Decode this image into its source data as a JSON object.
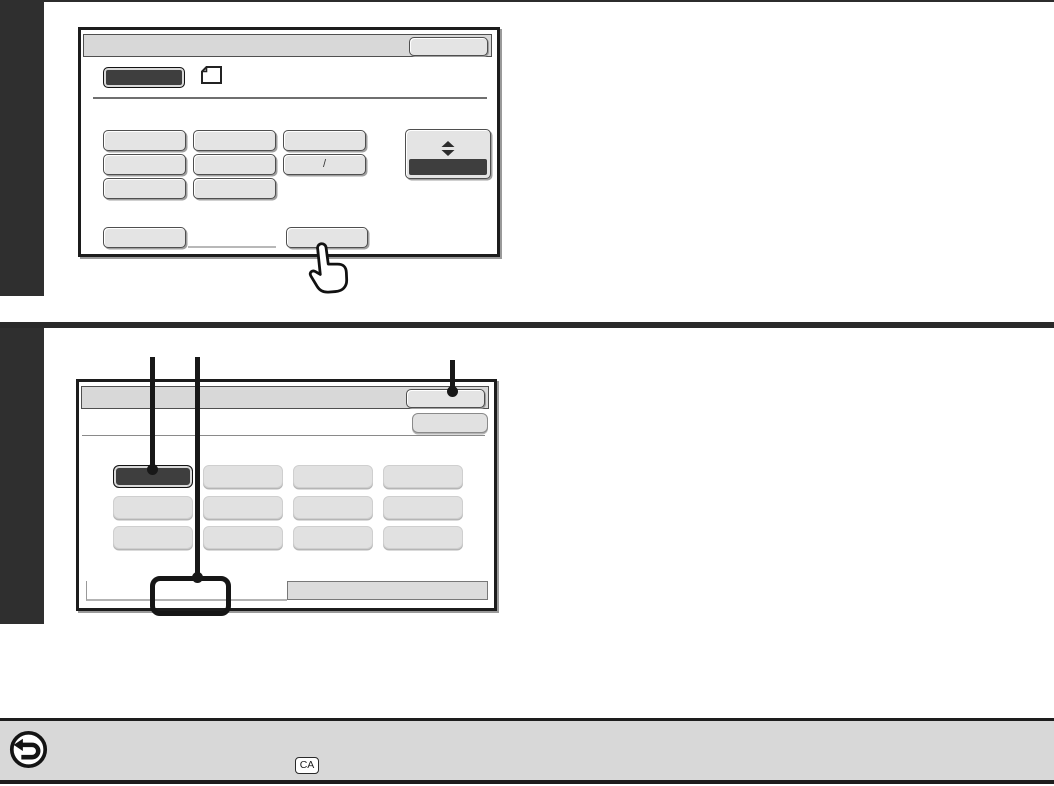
{
  "theme": {
    "sidebar_color": "#2f2f2f",
    "outline_color": "#1c1c1c",
    "titlebar_fill": "#d8d8d8",
    "button_fill": "#e4e4e4",
    "dark_button_fill": "#3e3e3e",
    "footer_fill": "#d8d8d8"
  },
  "screen1": {
    "titlebar": {
      "label": "",
      "action_button": ""
    },
    "mode_button": "",
    "original_icon": "original-document-icon",
    "buttons": {
      "r1c1": "",
      "r1c2": "",
      "r1c3": "",
      "r2c1": "",
      "r2c2": "",
      "r2c3": "/",
      "r3c1": "",
      "r3c2": ""
    },
    "scroll_button_icon": "up-down-arrows-icon",
    "bottom": {
      "left": "",
      "right": ""
    }
  },
  "screen2": {
    "titlebar": {
      "label": "",
      "action_button": ""
    },
    "header_button": "",
    "buttons": [
      "",
      "",
      "",
      "",
      "",
      "",
      "",
      "",
      "",
      "",
      "",
      ""
    ],
    "selected_index": 0,
    "tabs": {
      "left": "",
      "right": ""
    }
  },
  "footer": {
    "back_icon": "back-arrow-icon",
    "ca_key": "CA"
  }
}
